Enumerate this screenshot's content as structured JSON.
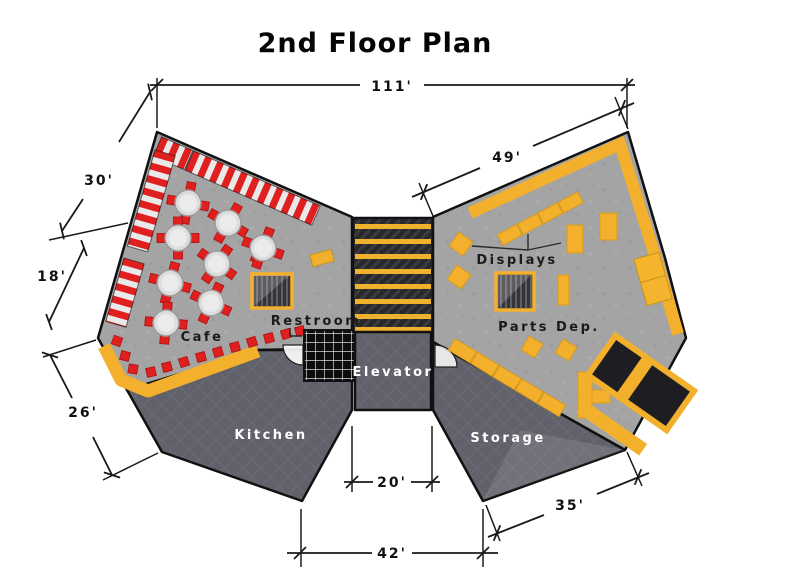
{
  "title": "2nd Floor Plan",
  "rooms": {
    "cafe": "Cafe",
    "kitchen": "Kitchen",
    "restroom": "Restroom",
    "elevator": "Elevator",
    "storage": "Storage",
    "parts_dept": "Parts Dep.",
    "displays": "Displays"
  },
  "dimensions": {
    "overall_width": "111'",
    "parts_wall": "49'",
    "cafe_wall_upper": "30'",
    "cafe_wall_lower": "18'",
    "kitchen_wall": "26'",
    "elevator_width": "20'",
    "bottom_span": "42'",
    "storage_wall": "35'"
  },
  "colors": {
    "accent_yellow": "#f3b02c",
    "accent_red": "#e01f1f",
    "floor_light": "#a4a4a4",
    "floor_dark": "#62626c",
    "corridor_dark": "#2a2a2e"
  }
}
